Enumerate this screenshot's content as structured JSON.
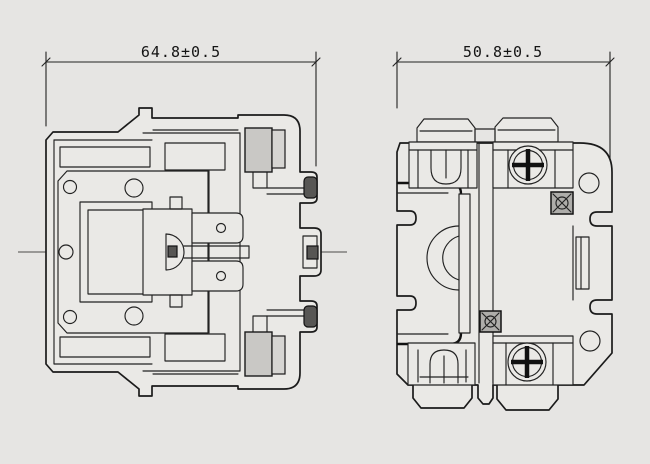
{
  "page": {
    "type": "technical-dimension-drawing",
    "subject": "contactor-outline-two-views",
    "background_color": "#e6e5e3",
    "line_color": "#1b1b1b"
  },
  "views": {
    "front": {
      "name": "front-view",
      "dimension_label": "64.8±0.5"
    },
    "side": {
      "name": "side-view",
      "dimension_label": "50.8±0.5"
    }
  }
}
